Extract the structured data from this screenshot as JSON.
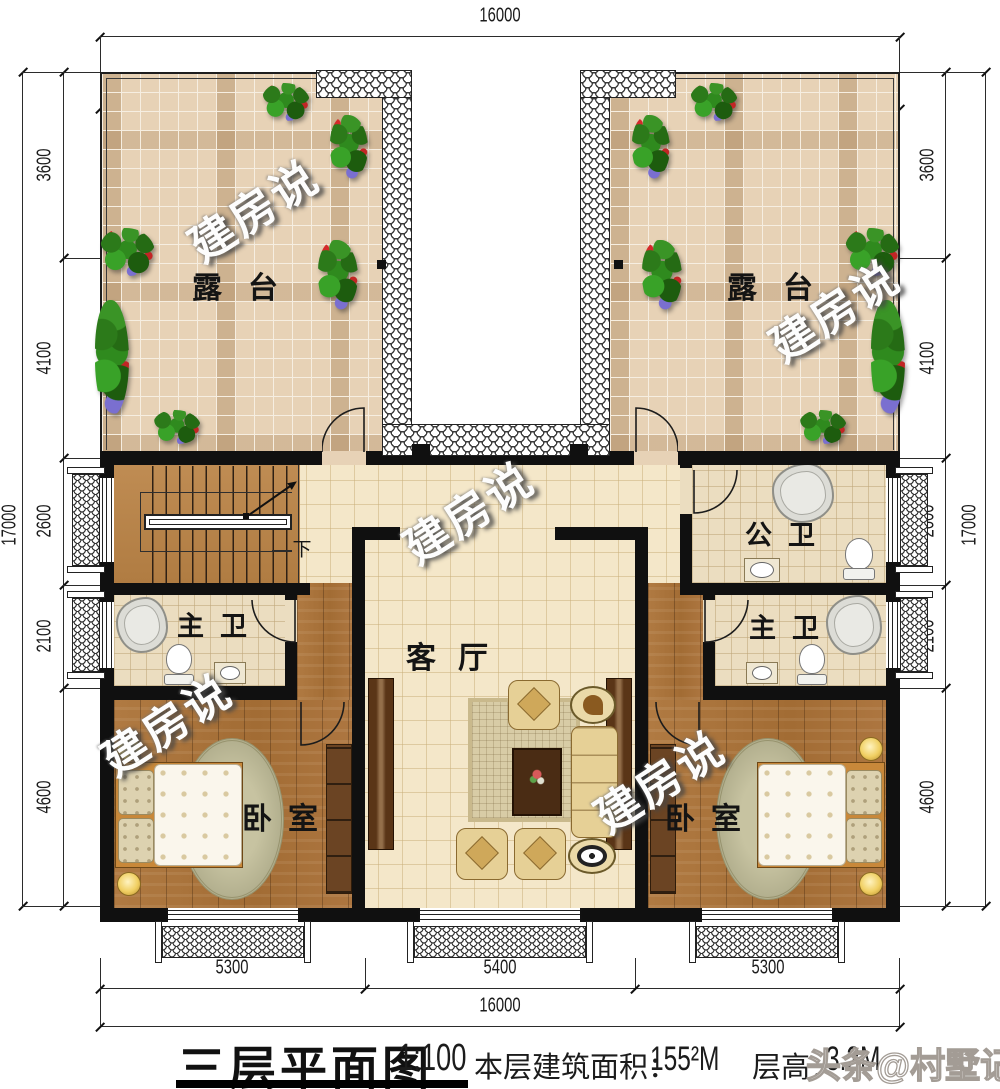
{
  "watermarks": {
    "brand": "建房说",
    "footer": "头条@村墅记"
  },
  "rooms": {
    "terrace": "露台",
    "living_room": "客厅",
    "bedroom": "卧室",
    "master_bath": "主卫",
    "public_bath": "公卫",
    "stairs_down": "下"
  },
  "dims": {
    "top_total": "16000",
    "top_segments": [
      "4200",
      "7600",
      "4200"
    ],
    "left_total": "17000",
    "left_segments": [
      "3600",
      "4100",
      "2600",
      "2100",
      "4600"
    ],
    "right_total": "17000",
    "right_segments": [
      "3600",
      "4100",
      "2600",
      "2100",
      "4600"
    ],
    "bottom_segments": [
      "5300",
      "5400",
      "5300"
    ],
    "bottom_total": "16000"
  },
  "title_block": {
    "title": "三层平面图",
    "scale": "1:100",
    "area_label": "本层建筑面积：",
    "area_value": "155²M",
    "height_label": "层高：",
    "height_value": "3.2M"
  },
  "colors": {
    "wall": "#101010",
    "terrace_tile": "#e7d2b6",
    "wood_floor": "#ab7440",
    "cream_floor": "#f4e7c9",
    "bath_tile": "#ebddc0",
    "rug": "#b6b394",
    "accent_dark_wood": "#5a3517"
  }
}
